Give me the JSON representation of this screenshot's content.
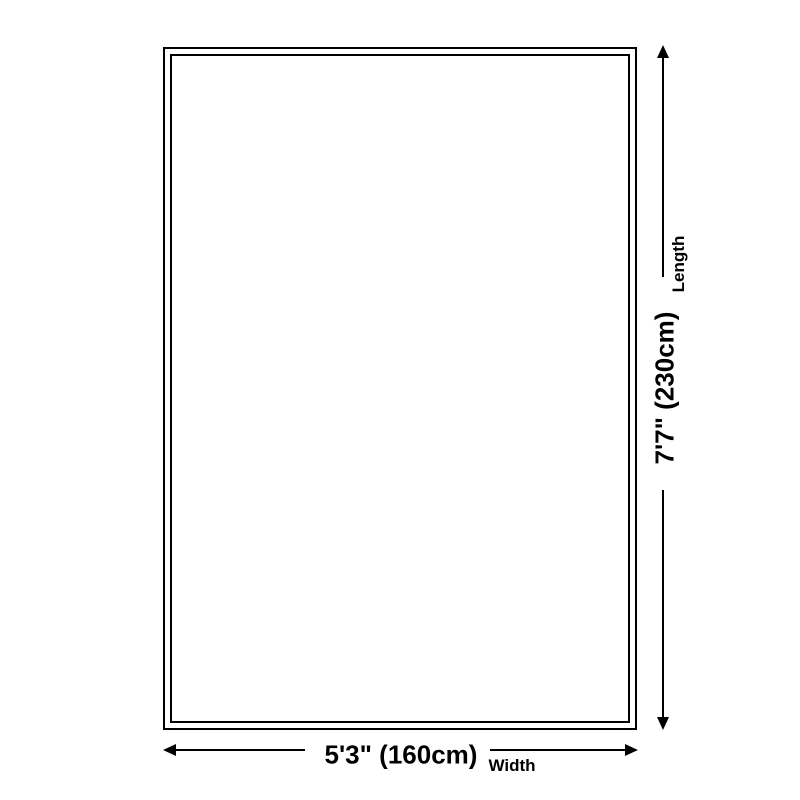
{
  "diagram": {
    "background_color": "#ffffff",
    "line_color": "#000000",
    "length": {
      "axis_label": "Length",
      "value": "7'7\" (230cm)"
    },
    "width": {
      "axis_label": "Width",
      "value": "5'3\" (160cm)"
    }
  }
}
